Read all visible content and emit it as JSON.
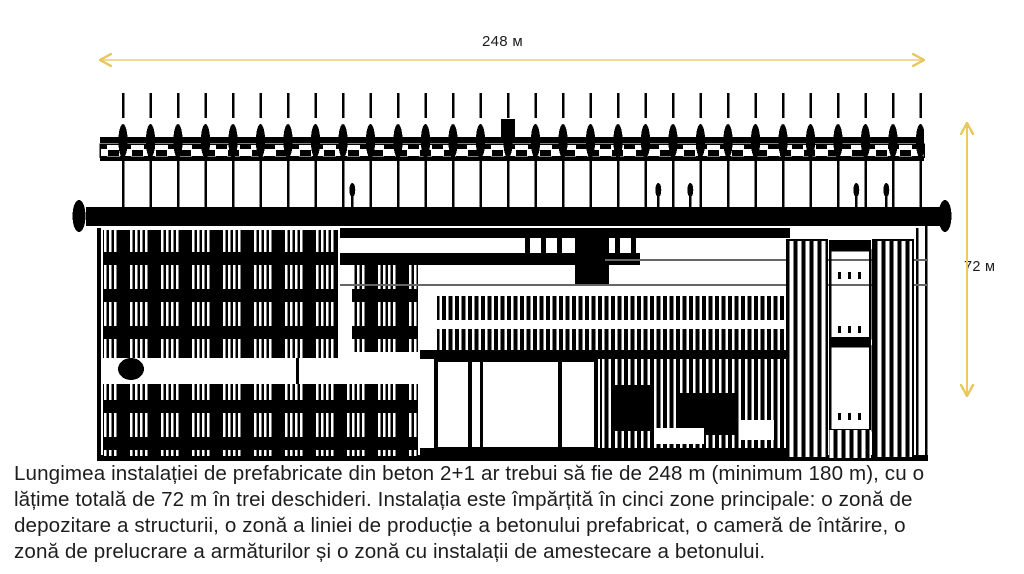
{
  "colors": {
    "background": "#ffffff",
    "ink": "#000000",
    "caption_text": "#1d1d1f",
    "dim_label_text": "#1d1d1f",
    "dim_line": "#f1d99b",
    "dim_head": "#e9c75f",
    "dim_line_vertical": "#f3c75f",
    "muted_line": "#666666"
  },
  "dimensions": {
    "length": {
      "label": "248 м"
    },
    "width": {
      "label": "72 м"
    }
  },
  "caption": {
    "lines": [
      "Lungimea instalației de prefabricate din beton 2+1 ar trebui să fie de 248 m (minimum 180 m), cu o",
      "lățime totală de 72 m în trei deschideri. Instalația este împărțită în cinci zone principale: o zonă de",
      "depozitare a structurii, o zonă a liniei de producție a betonului prefabricat, o cameră de întărire, o",
      "zonă de prelucrare a armăturilor și o zonă cu instalații de amestecare a betonului."
    ]
  }
}
